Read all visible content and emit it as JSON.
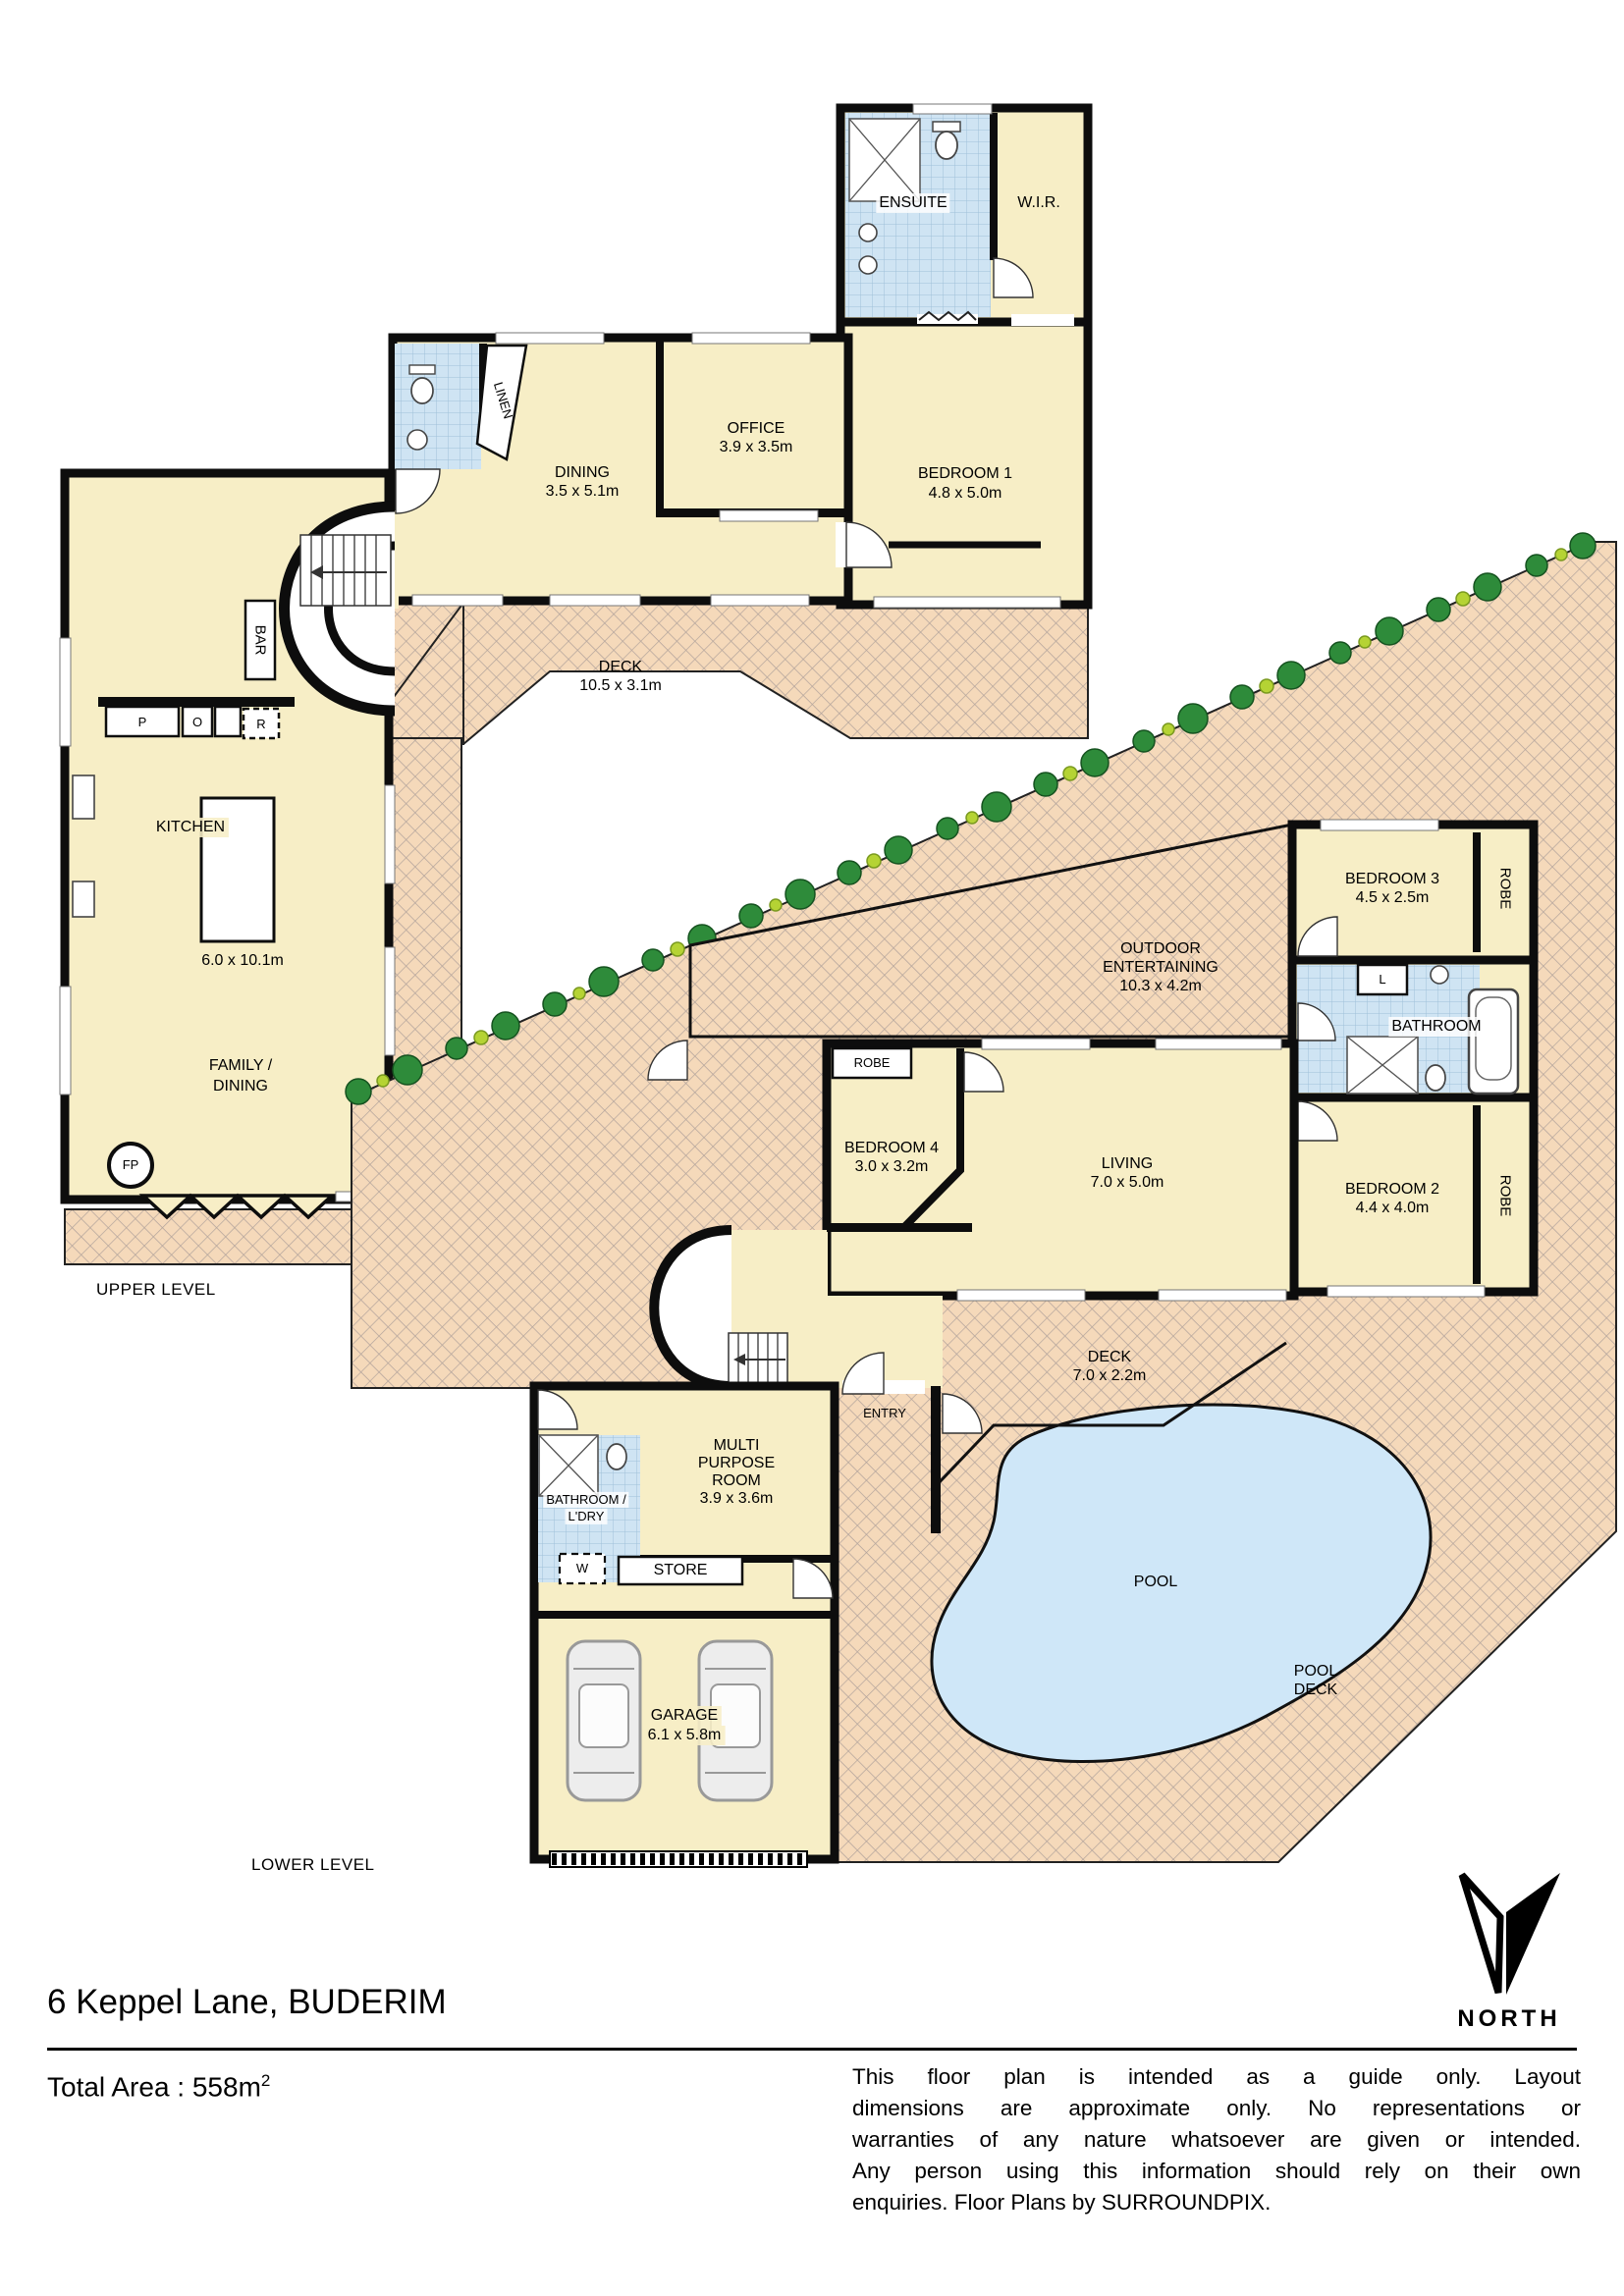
{
  "title": {
    "address": "6 Keppel Lane, BUDERIM",
    "total_area": "Total Area : 558m",
    "total_area_exp": "2",
    "north": "NORTH",
    "upper_level": "UPPER LEVEL",
    "lower_level": "LOWER LEVEL",
    "d1": "This floor plan is intended as a guide only. Layout",
    "d2": "dimensions are approximate only. No representations or",
    "d3": "warranties of any nature whatsoever are given or intended.",
    "d4": "Any person using this information should rely on their own",
    "d5": "enquiries. Floor Plans by  SURROUNDPIX."
  },
  "u": {
    "ensuite": "ENSUITE",
    "wir": "W.I.R.",
    "bed1": "BEDROOM 1",
    "bed1d": "4.8 x 5.0m",
    "office": "OFFICE",
    "officed": "3.9 x 3.5m",
    "dining": "DINING",
    "diningd": "3.5 x 5.1m",
    "linen": "LINEN",
    "bar": "BAR",
    "p": "P",
    "o": "O",
    "r": "R",
    "kitchen": "KITCHEN",
    "kitchend": "6.0 x 10.1m",
    "fam1": "FAMILY /",
    "fam2": "DINING",
    "fp": "FP",
    "deck": "DECK",
    "deckd": "10.5 x 3.1m"
  },
  "l": {
    "bed3": "BEDROOM 3",
    "bed3d": "4.5 x 2.5m",
    "robe3": "ROBE",
    "linen": "L",
    "bath": "BATHROOM",
    "bed2": "BEDROOM 2",
    "bed2d": "4.4 x 4.0m",
    "robe2": "ROBE",
    "out1": "OUTDOOR",
    "out2": "ENTERTAINING",
    "out3": "10.3 x 4.2m",
    "robe4": "ROBE",
    "bed4": "BEDROOM 4",
    "bed4d": "3.0 x 3.2m",
    "living": "LIVING",
    "livingd": "7.0 x 5.0m",
    "entry": "ENTRY",
    "deck": "DECK",
    "deckd": "7.0 x 2.2m",
    "pool": "POOL",
    "pd1": "POOL",
    "pd2": "DECK",
    "m1": "MULTI",
    "m2": "PURPOSE",
    "m3": "ROOM",
    "m4": "3.9 x 3.6m",
    "bl1": "BATHROOM /",
    "bl2": "L'DRY",
    "w": "W",
    "store": "STORE",
    "garage": "GARAGE",
    "garaged": "6.1 x 5.8m"
  },
  "colors": {
    "room": "#f7eec6",
    "hatch_bg": "#f5d9ba",
    "hatch_line": "#b3a49c",
    "tile_bg": "#cfe4f3",
    "tile_line": "#9fc0d8",
    "pool": "#cfe7f8",
    "wall": "#0d0d0d",
    "tree_dark": "#2e8b3a",
    "tree_light": "#b5d334"
  }
}
